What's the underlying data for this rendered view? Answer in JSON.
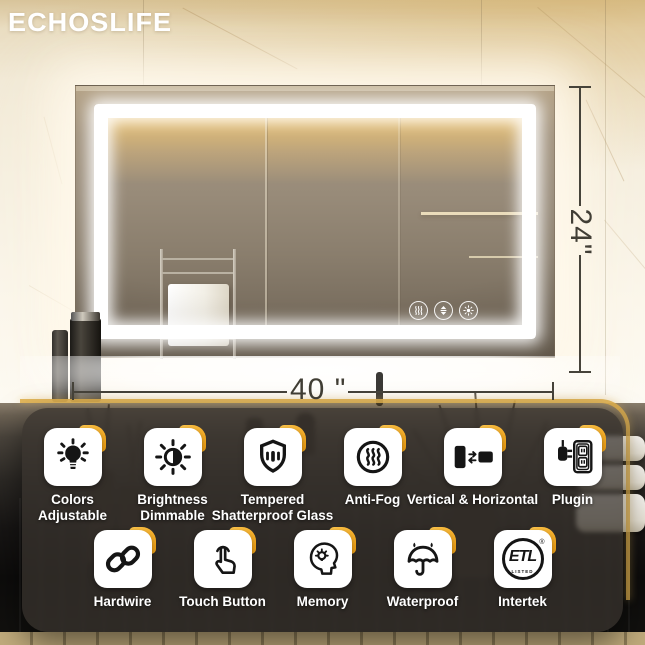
{
  "brand": {
    "name": "ECHOSLIFE"
  },
  "annotations": {
    "width_label": "40 \"",
    "height_label": "24\""
  },
  "mirror": {
    "touch_buttons": [
      {
        "name": "anti-fog-touch-button"
      },
      {
        "name": "brightness-touch-button"
      },
      {
        "name": "color-temp-touch-button"
      }
    ]
  },
  "features": {
    "row1": [
      {
        "label": "Colors\nAdjustable",
        "icon": "bulb-icon"
      },
      {
        "label": "Brightness\nDimmable",
        "icon": "brightness-icon"
      },
      {
        "label": "Tempered\nShatterproof Glass",
        "icon": "shield-icon"
      },
      {
        "label": "Anti-Fog",
        "icon": "steam-icon"
      },
      {
        "label": "Vertical & Horizontal",
        "icon": "orientation-icon"
      },
      {
        "label": "Plugin",
        "icon": "plug-icon"
      }
    ],
    "row2": [
      {
        "label": "Hardwire",
        "icon": "chain-icon"
      },
      {
        "label": "Touch Button",
        "icon": "touch-icon"
      },
      {
        "label": "Memory",
        "icon": "memory-icon"
      },
      {
        "label": "Waterproof",
        "icon": "umbrella-icon"
      },
      {
        "label": "Intertek",
        "icon": "etl-icon"
      }
    ]
  },
  "etl": {
    "text": "ETL",
    "listed": "LISTED",
    "reg": "®"
  },
  "colors": {
    "accent_orange": "#F2A51D",
    "led_strip_gold": "#E0B14F",
    "dimension_line": "#46433A",
    "panel_background": "rgba(56,51,45,0.75)",
    "tile_background": "#FFFFFF",
    "label_text": "#FFFFFF",
    "wall_beige": "#F2EAD7"
  }
}
